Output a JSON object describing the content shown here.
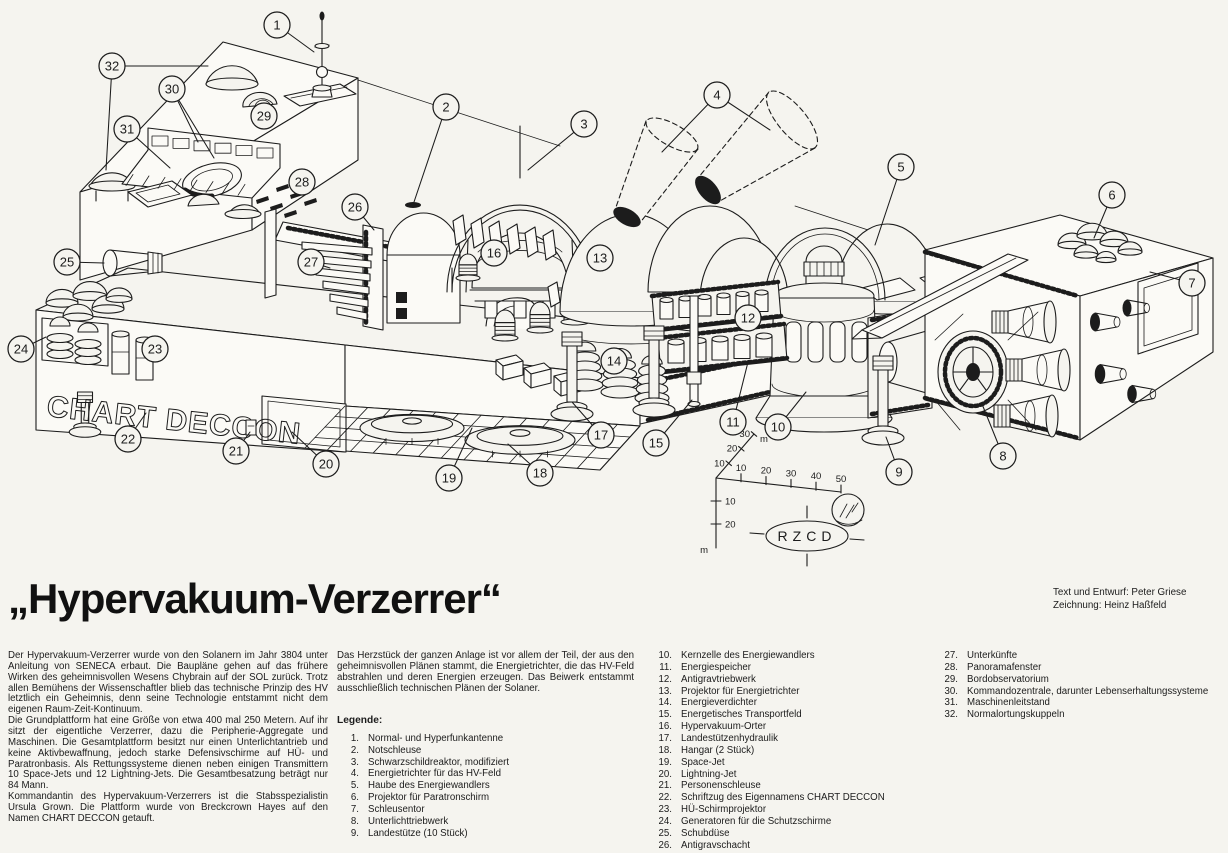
{
  "title": "„Hypervakuum-Verzerrer“",
  "credits": [
    "Text und Entwurf: Peter Griese",
    "Zeichnung: Heinz Haßfeld"
  ],
  "intro_left": [
    "Der Hypervakuum-Verzerrer wurde von den Solanern im Jahr 3804 unter Anleitung von SENECA erbaut. Die Baupläne gehen auf das frühere Wirken des geheimnisvollen Wesens Chybrain auf der SOL zurück. Trotz allen Bemühens der Wissenschaftler blieb das technische Prinzip des HV letztlich ein Geheimnis, denn seine Technologie entstammt nicht dem eigenen Raum-Zeit-Kontinuum.",
    "Die Grundplattform hat eine Größe von etwa 400 mal 250 Metern. Auf ihr sitzt der eigentliche Verzerrer, dazu die Peripherie-Aggregate und Maschinen. Die Gesamtplattform besitzt nur einen Unterlichtantrieb und keine Aktivbewaffnung, jedoch starke Defensivschirme auf HÜ- und Paratronbasis. Als Rettungssysteme dienen neben einigen Transmittern 10 Space-Jets und 12 Lightning-Jets. Die Gesamtbesatzung beträgt nur 84 Mann.",
    "Kommandantin des Hypervakuum-Verzerrers ist die Stabsspezialistin Ursula Grown. Die Plattform wurde von Breckcrown Hayes auf den Namen CHART DECCON getauft."
  ],
  "intro_middle": "Das Herzstück der ganzen Anlage ist vor allem der Teil, der aus den geheimnisvollen Plänen stammt, die Energietrichter, die das HV-Feld abstrahlen und deren Energien erzeugen. Das Beiwerk entstammt ausschließlich technischen Plänen der Solaner.",
  "legend_heading": "Legende:",
  "legend": [
    {
      "num": "1.",
      "label": "Normal- und Hyperfunkantenne"
    },
    {
      "num": "2.",
      "label": "Notschleuse"
    },
    {
      "num": "3.",
      "label": "Schwarzschildreaktor, modifiziert"
    },
    {
      "num": "4.",
      "label": "Energietrichter für das HV-Feld"
    },
    {
      "num": "5.",
      "label": "Haube des Energiewandlers"
    },
    {
      "num": "6.",
      "label": "Projektor für Paratronschirm"
    },
    {
      "num": "7.",
      "label": "Schleusentor"
    },
    {
      "num": "8.",
      "label": "Unterlichttriebwerk"
    },
    {
      "num": "9.",
      "label": "Landestütze (10 Stück)"
    },
    {
      "num": "10.",
      "label": "Kernzelle des Energiewandlers"
    },
    {
      "num": "11.",
      "label": "Energiespeicher"
    },
    {
      "num": "12.",
      "label": "Antigravtriebwerk"
    },
    {
      "num": "13.",
      "label": "Projektor für Energietrichter"
    },
    {
      "num": "14.",
      "label": "Energieverdichter"
    },
    {
      "num": "15.",
      "label": "Energetisches Transportfeld"
    },
    {
      "num": "16.",
      "label": "Hypervakuum-Orter"
    },
    {
      "num": "17.",
      "label": "Landestützenhydraulik"
    },
    {
      "num": "18.",
      "label": "Hangar (2 Stück)"
    },
    {
      "num": "19.",
      "label": "Space-Jet"
    },
    {
      "num": "20.",
      "label": "Lightning-Jet"
    },
    {
      "num": "21.",
      "label": "Personenschleuse"
    },
    {
      "num": "22.",
      "label": "Schriftzug des Eigennamens CHART DECCON"
    },
    {
      "num": "23.",
      "label": "HÜ-Schirmprojektor"
    },
    {
      "num": "24.",
      "label": "Generatoren für die Schutzschirme"
    },
    {
      "num": "25.",
      "label": "Schubdüse"
    },
    {
      "num": "26.",
      "label": "Antigravschacht"
    },
    {
      "num": "27.",
      "label": "Unterkünfte"
    },
    {
      "num": "28.",
      "label": "Panoramafenster"
    },
    {
      "num": "29.",
      "label": "Bordobservatorium"
    },
    {
      "num": "30.",
      "label": "Kommandozentrale, darunter Lebenserhaltungssysteme"
    },
    {
      "num": "31.",
      "label": "Maschinenleitstand"
    },
    {
      "num": "32.",
      "label": "Normalortungskuppeln"
    }
  ],
  "ship_name": "CHART DECCON",
  "marker_label": "RZCD",
  "scale": {
    "up_ticks": [
      "10",
      "20",
      "30"
    ],
    "right_ticks": [
      "10",
      "20",
      "30",
      "40",
      "50"
    ],
    "down_ticks": [
      "10",
      "20"
    ],
    "unit": "m"
  },
  "callouts": [
    {
      "n": "1",
      "x": 277,
      "y": 25,
      "tx": 314,
      "ty": 52
    },
    {
      "n": "2",
      "x": 446,
      "y": 107,
      "tx": 414,
      "ty": 202
    },
    {
      "n": "3",
      "x": 584,
      "y": 124,
      "tx": 528,
      "ty": 170
    },
    {
      "n": "4",
      "x": 717,
      "y": 95,
      "tx": 662,
      "ty": 152
    },
    {
      "n": "5",
      "x": 901,
      "y": 167,
      "tx": 875,
      "ty": 245
    },
    {
      "n": "6",
      "x": 1112,
      "y": 195,
      "tx": 1094,
      "ty": 238
    },
    {
      "n": "7",
      "x": 1192,
      "y": 283,
      "tx": 1150,
      "ty": 272
    },
    {
      "n": "8",
      "x": 1003,
      "y": 456,
      "tx": 982,
      "ty": 404
    },
    {
      "n": "9",
      "x": 899,
      "y": 472,
      "tx": 886,
      "ty": 437
    },
    {
      "n": "10",
      "x": 778,
      "y": 427,
      "tx": 806,
      "ty": 392
    },
    {
      "n": "11",
      "x": 733,
      "y": 422,
      "tx": 748,
      "ty": 362
    },
    {
      "n": "12",
      "x": 748,
      "y": 318,
      "tx": null,
      "ty": null
    },
    {
      "n": "13",
      "x": 600,
      "y": 258,
      "tx": null,
      "ty": null
    },
    {
      "n": "14",
      "x": 614,
      "y": 361,
      "tx": null,
      "ty": null
    },
    {
      "n": "15",
      "x": 656,
      "y": 443,
      "tx": 692,
      "ty": 400
    },
    {
      "n": "16",
      "x": 494,
      "y": 253,
      "tx": null,
      "ty": null
    },
    {
      "n": "17",
      "x": 601,
      "y": 435,
      "tx": 572,
      "ty": 402
    },
    {
      "n": "18",
      "x": 540,
      "y": 473,
      "tx": 508,
      "ty": 444
    },
    {
      "n": "19",
      "x": 449,
      "y": 478,
      "tx": 472,
      "ty": 428
    },
    {
      "n": "20",
      "x": 326,
      "y": 464,
      "tx": 292,
      "ty": 432
    },
    {
      "n": "21",
      "x": 236,
      "y": 451,
      "tx": 250,
      "ty": 432
    },
    {
      "n": "22",
      "x": 128,
      "y": 439,
      "tx": 146,
      "ty": 413
    },
    {
      "n": "23",
      "x": 155,
      "y": 349,
      "tx": null,
      "ty": null
    },
    {
      "n": "24",
      "x": 21,
      "y": 349,
      "tx": 46,
      "ty": 337
    },
    {
      "n": "25",
      "x": 67,
      "y": 262,
      "tx": 104,
      "ty": 263
    },
    {
      "n": "26",
      "x": 355,
      "y": 207,
      "tx": 374,
      "ty": 230
    },
    {
      "n": "27",
      "x": 311,
      "y": 262,
      "tx": 330,
      "ty": 268
    },
    {
      "n": "28",
      "x": 302,
      "y": 182,
      "tx": null,
      "ty": null
    },
    {
      "n": "29",
      "x": 264,
      "y": 116,
      "tx": 258,
      "ty": 108
    },
    {
      "n": "30",
      "x": 172,
      "y": 89,
      "tx": 198,
      "ty": 142
    },
    {
      "n": "31",
      "x": 127,
      "y": 129,
      "tx": 170,
      "ty": 168
    },
    {
      "n": "32",
      "x": 112,
      "y": 66,
      "tx": 208,
      "ty": 66
    }
  ],
  "extra_leaders": [
    [
      717,
      95,
      770,
      130
    ],
    [
      172,
      89,
      214,
      158
    ],
    [
      112,
      66,
      106,
      170
    ]
  ],
  "colors": {
    "ink": "#1c1c1c",
    "paper": "#f5f4ef"
  }
}
